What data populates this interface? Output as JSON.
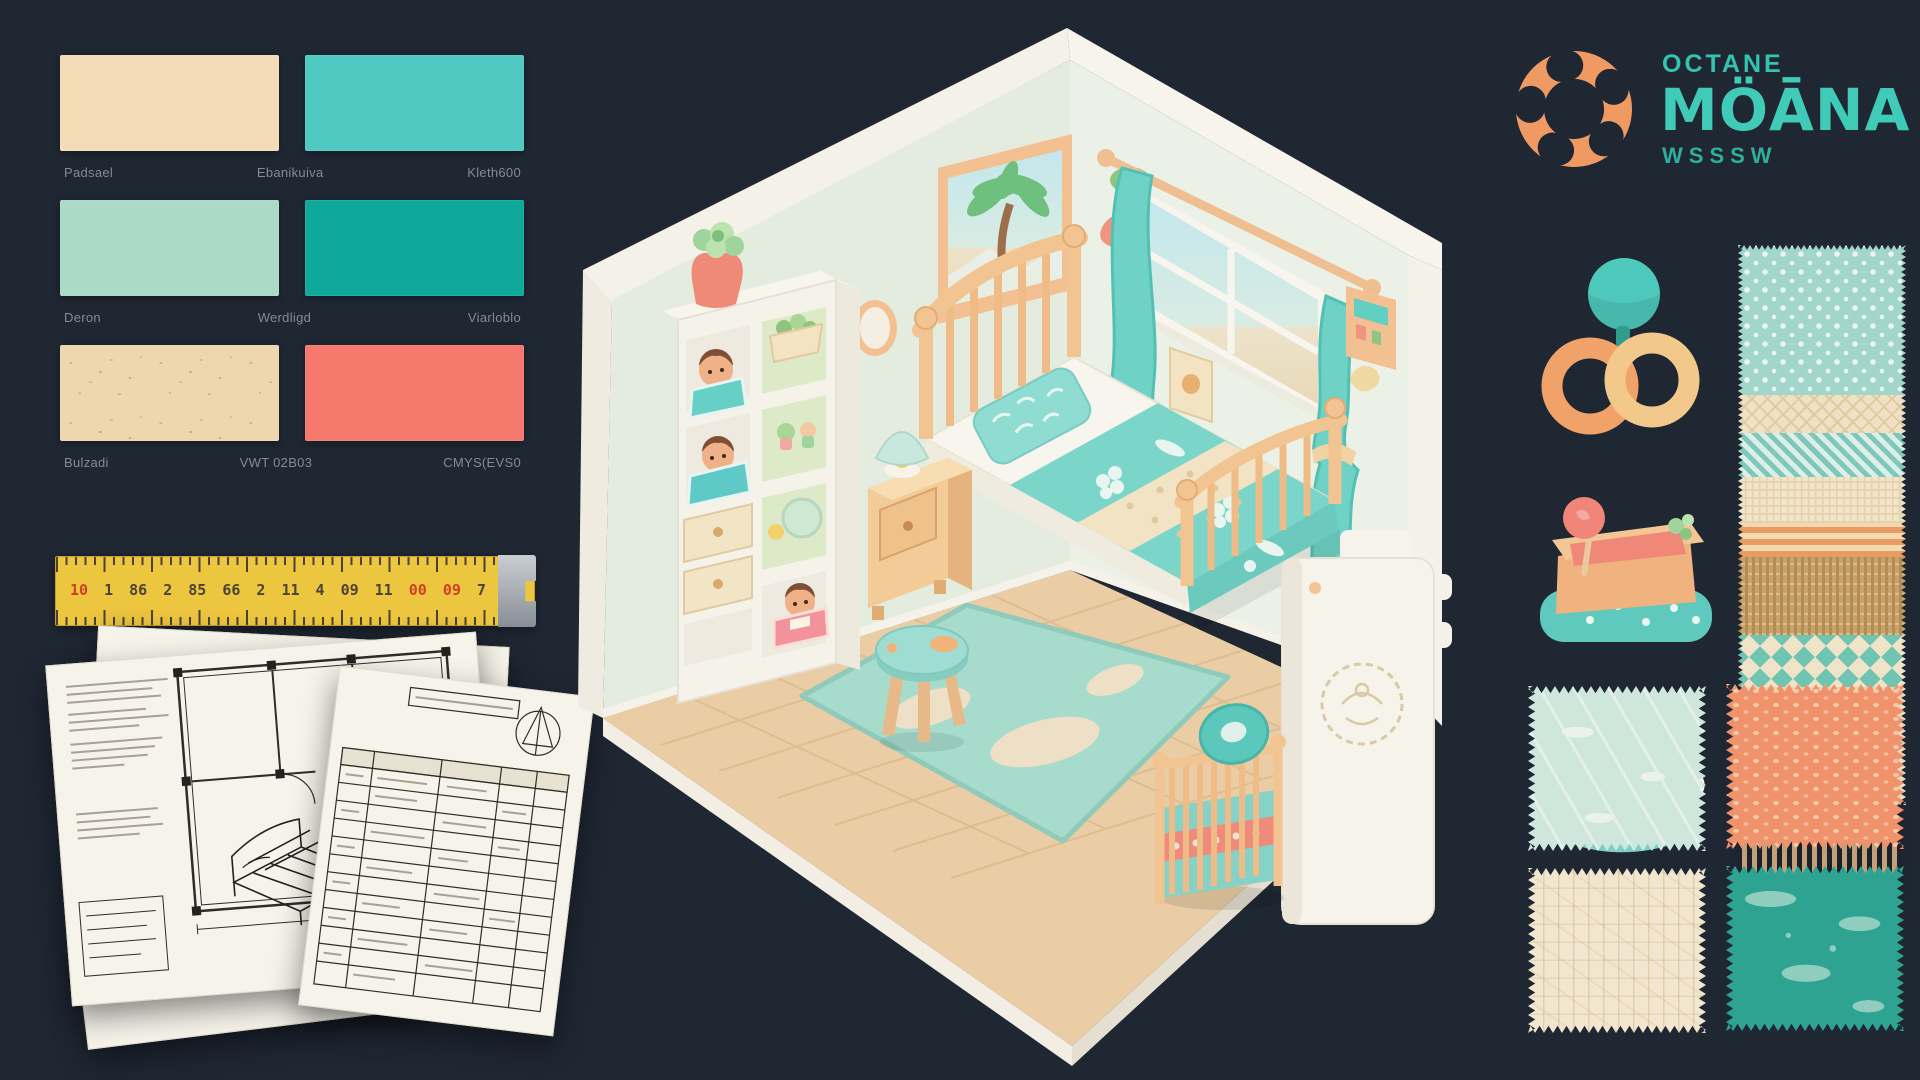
{
  "canvas": {
    "background": "#1F2733"
  },
  "logo": {
    "top": "OCTANE",
    "main": "MÖĀNA",
    "sub": "WSSSW",
    "ring_color": "#F09A63",
    "text_color": "#3FCBB8"
  },
  "palette": {
    "rows": [
      {
        "swatches": [
          {
            "color": "#F2DBB6",
            "textured": false
          },
          {
            "color": "#4FC9C2",
            "textured": false
          }
        ],
        "labels": [
          "Padsael",
          "Ebanikuiva",
          "Kleth600"
        ]
      },
      {
        "swatches": [
          {
            "color": "#ABDAC6",
            "textured": false
          },
          {
            "color": "#0FA99B",
            "textured": false
          }
        ],
        "labels": [
          "Deron",
          "Werdligd",
          "Viarloblo"
        ]
      },
      {
        "swatches": [
          {
            "color": "#ECD7AF",
            "textured": true
          },
          {
            "color": "#F5796C",
            "textured": false
          }
        ],
        "labels": [
          "Bulzadi",
          "VWT 02B03",
          "CMYS(EVS0"
        ]
      }
    ]
  },
  "ruler": {
    "numbers": [
      {
        "text": "10",
        "red": true
      },
      {
        "text": "1",
        "red": false
      },
      {
        "text": "86",
        "red": false
      },
      {
        "text": "2",
        "red": false
      },
      {
        "text": "85",
        "red": false
      },
      {
        "text": "66",
        "red": false
      },
      {
        "text": "2",
        "red": false
      },
      {
        "text": "11",
        "red": false
      },
      {
        "text": "4",
        "red": false
      },
      {
        "text": "09",
        "red": false
      },
      {
        "text": "11",
        "red": false
      },
      {
        "text": "00",
        "red": true
      },
      {
        "text": "09",
        "red": true
      },
      {
        "text": "7",
        "red": false
      }
    ]
  },
  "icons": [
    {
      "name": "rings-toy"
    },
    {
      "name": "sandbox-toy"
    },
    {
      "name": "bag-toy",
      "letters": [
        "0",
        "T"
      ]
    }
  ],
  "fabric_strip": {
    "bands": [
      {
        "name": "teal-dots",
        "class": "b-teal-dots",
        "height": 150
      },
      {
        "name": "cream-diamond",
        "class": "b-cream-diamond",
        "height": 38
      },
      {
        "name": "teal-check",
        "class": "b-teal-check",
        "height": 44
      },
      {
        "name": "cream-knit",
        "class": "b-cream-knit",
        "height": 46
      },
      {
        "name": "orange-stripe",
        "class": "b-orange-stripe",
        "height": 34
      },
      {
        "name": "tan-weave",
        "class": "b-tan-weave",
        "height": 78
      },
      {
        "name": "wave-teal",
        "class": "b-wave-teal",
        "height": 52
      },
      {
        "name": "cream-knit-2",
        "class": "b-cream-knit",
        "height": 34
      },
      {
        "name": "wave-coral",
        "class": "b-wave-coral",
        "height": 46
      },
      {
        "name": "cream-knit-3",
        "class": "b-cream-knit",
        "height": 38
      }
    ]
  },
  "fabric_swatches": [
    {
      "name": "mint-wave-fabric",
      "color": "#CFE6DC"
    },
    {
      "name": "coral-dot-fabric",
      "color": "#F0926B"
    },
    {
      "name": "cream-scribble-fabric",
      "color": "#F3E6D0"
    },
    {
      "name": "teal-leaf-fabric",
      "color": "#2EA392"
    }
  ],
  "room": {
    "wall_color": "#E4ECDF",
    "floor_color": "#EACDA4",
    "bedding_color": "#7CD5C9",
    "wood_color": "#F2C28F",
    "accent_coral": "#F08878",
    "rug_color": "#A7DBCC"
  }
}
